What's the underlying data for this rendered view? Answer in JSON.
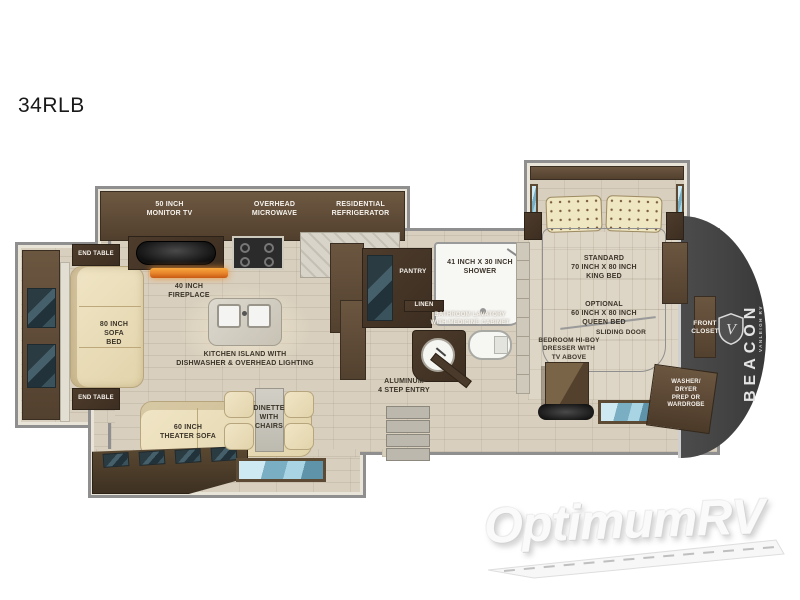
{
  "page": {
    "title": "34RLB"
  },
  "brand": {
    "name": "BEACON",
    "tagline": "VANLEIGH RV",
    "logo_icon": "shield-icon"
  },
  "watermark": {
    "text": "OptimumRV"
  },
  "colors": {
    "floor": "#d8cfbe",
    "floor_bedroom": "#ddd5c5",
    "wall": "#8f8f8f",
    "cabinet": "#5f4b37",
    "cabinet_dark": "#46362a",
    "counter": "#d8d4c9",
    "upholstery": "#ecdfbd",
    "mattress": "#bdbdbd",
    "glass": "#8fc1d4",
    "front_cap": "#424242",
    "fire": "#e8862c",
    "label": "#3b3429",
    "label_light": "#f5f2ec",
    "watermark": "#fafafa"
  },
  "labels": {
    "monitor_tv": "50 INCH\nMONITOR TV",
    "overhead_microwave": "OVERHEAD\nMICROWAVE",
    "residential_refrigerator": "RESIDENTIAL\nREFRIGERATOR",
    "end_table_top": "END TABLE",
    "end_table_bottom": "END TABLE",
    "sofa_bed": "80 INCH\nSOFA\nBED",
    "fireplace": "40 INCH\nFIREPLACE",
    "kitchen_island": "KITCHEN ISLAND WITH\nDISHWASHER & OVERHEAD LIGHTING",
    "theater_sofa": "60 INCH\nTHEATER SOFA",
    "dinette": "DINETTE\nWITH\nCHAIRS",
    "pantry": "PANTRY",
    "shower": "41 INCH X 30 INCH\nSHOWER",
    "linen": "LINEN",
    "bathroom_lavatory": "BATHROOM LAVATORY\nWITH MEDICINE CABINET",
    "entry": "ALUMINUM\n4 STEP ENTRY",
    "bed_standard": "STANDARD\n70 INCH X 80 INCH\nKING BED",
    "bed_optional": "OPTIONAL\n60 INCH X 80 INCH\nQUEEN BED",
    "sliding_door": "SLIDING DOOR",
    "front_closet": "FRONT\nCLOSET",
    "dresser": "BEDROOM HI-BOY\nDRESSER WITH\nTV ABOVE",
    "washer_dryer": "WASHER/\nDRYER\nPREP OR\nWARDROBE"
  }
}
